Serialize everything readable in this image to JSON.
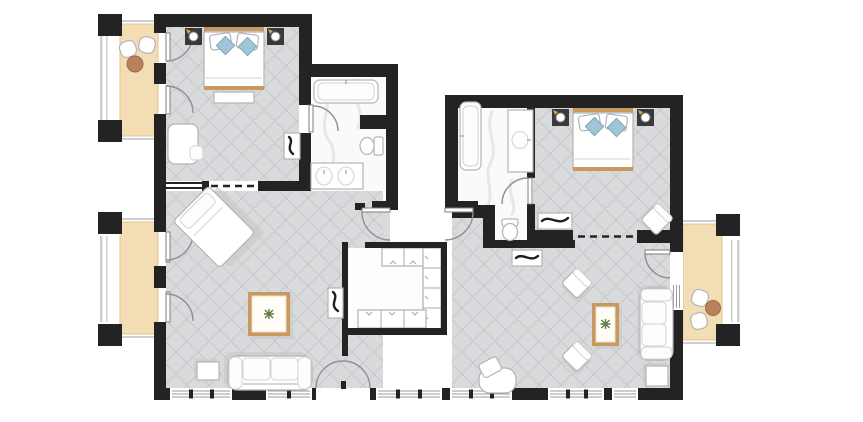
{
  "document": {
    "title": "two-bedroom-suite-floor-plan",
    "type": "architectural-floor-plan",
    "visible_text": []
  },
  "colors": {
    "wall": "#232324",
    "floor": "#d9dadc",
    "hatch": "#c7c8cb",
    "marble": "#fafafb",
    "vein": "#e7e7ea",
    "deck": "#f3ddb5",
    "plank": "#d5ab77",
    "deckEdge": "#e6c492",
    "accent": "#c9985f",
    "pillowBlue": "#9fc6d6",
    "pillowBand": "#bdd8e3",
    "furnitureStroke": "#b4b4b8",
    "shadow": "#c6c6c9",
    "nightstand": "#39393b",
    "orange": "#e8a33d",
    "plant": "#5d7f45",
    "tableTan": "#b9825c",
    "arc": "#909094",
    "glass": "#9b9b9f",
    "railing": "#cfcfd3"
  },
  "rooms": [
    {
      "name": "bedroom-1",
      "features": [
        "double-bed",
        "nightstand-left",
        "nightstand-right",
        "foot-bench",
        "desk",
        "console-decor"
      ]
    },
    {
      "name": "bathroom-1",
      "features": [
        "bathtub",
        "toilet",
        "double-sink-vanity",
        "door"
      ]
    },
    {
      "name": "living-room-1",
      "features": [
        "chaise-longue",
        "coffee-table-with-plant",
        "sofa",
        "side-table",
        "console-decor",
        "terrace-double-door"
      ]
    },
    {
      "name": "walk-in-closet",
      "features": [
        "wardrobe-top-row",
        "wardrobe-right-column",
        "wardrobe-bottom-row"
      ]
    },
    {
      "name": "entry-porch",
      "features": [
        "entry-door-left",
        "entry-door-right"
      ]
    },
    {
      "name": "bathroom-2",
      "features": [
        "bathtub",
        "toilet",
        "single-sink-vanity",
        "door"
      ]
    },
    {
      "name": "bedroom-2",
      "features": [
        "double-bed",
        "nightstand-left",
        "nightstand-right",
        "luggage-bench",
        "corner-chair"
      ]
    },
    {
      "name": "living-room-2",
      "features": [
        "sofa",
        "side-table",
        "coffee-table-with-plant",
        "armchair-upper",
        "armchair-lower",
        "tub-chair",
        "hall-console",
        "balcony-door"
      ]
    },
    {
      "name": "balcony-top-left",
      "features": [
        "deck",
        "chair",
        "chair",
        "round-table"
      ]
    },
    {
      "name": "balcony-mid-left",
      "features": [
        "deck"
      ]
    },
    {
      "name": "balcony-right",
      "features": [
        "deck",
        "chair",
        "chair",
        "round-table"
      ]
    }
  ]
}
